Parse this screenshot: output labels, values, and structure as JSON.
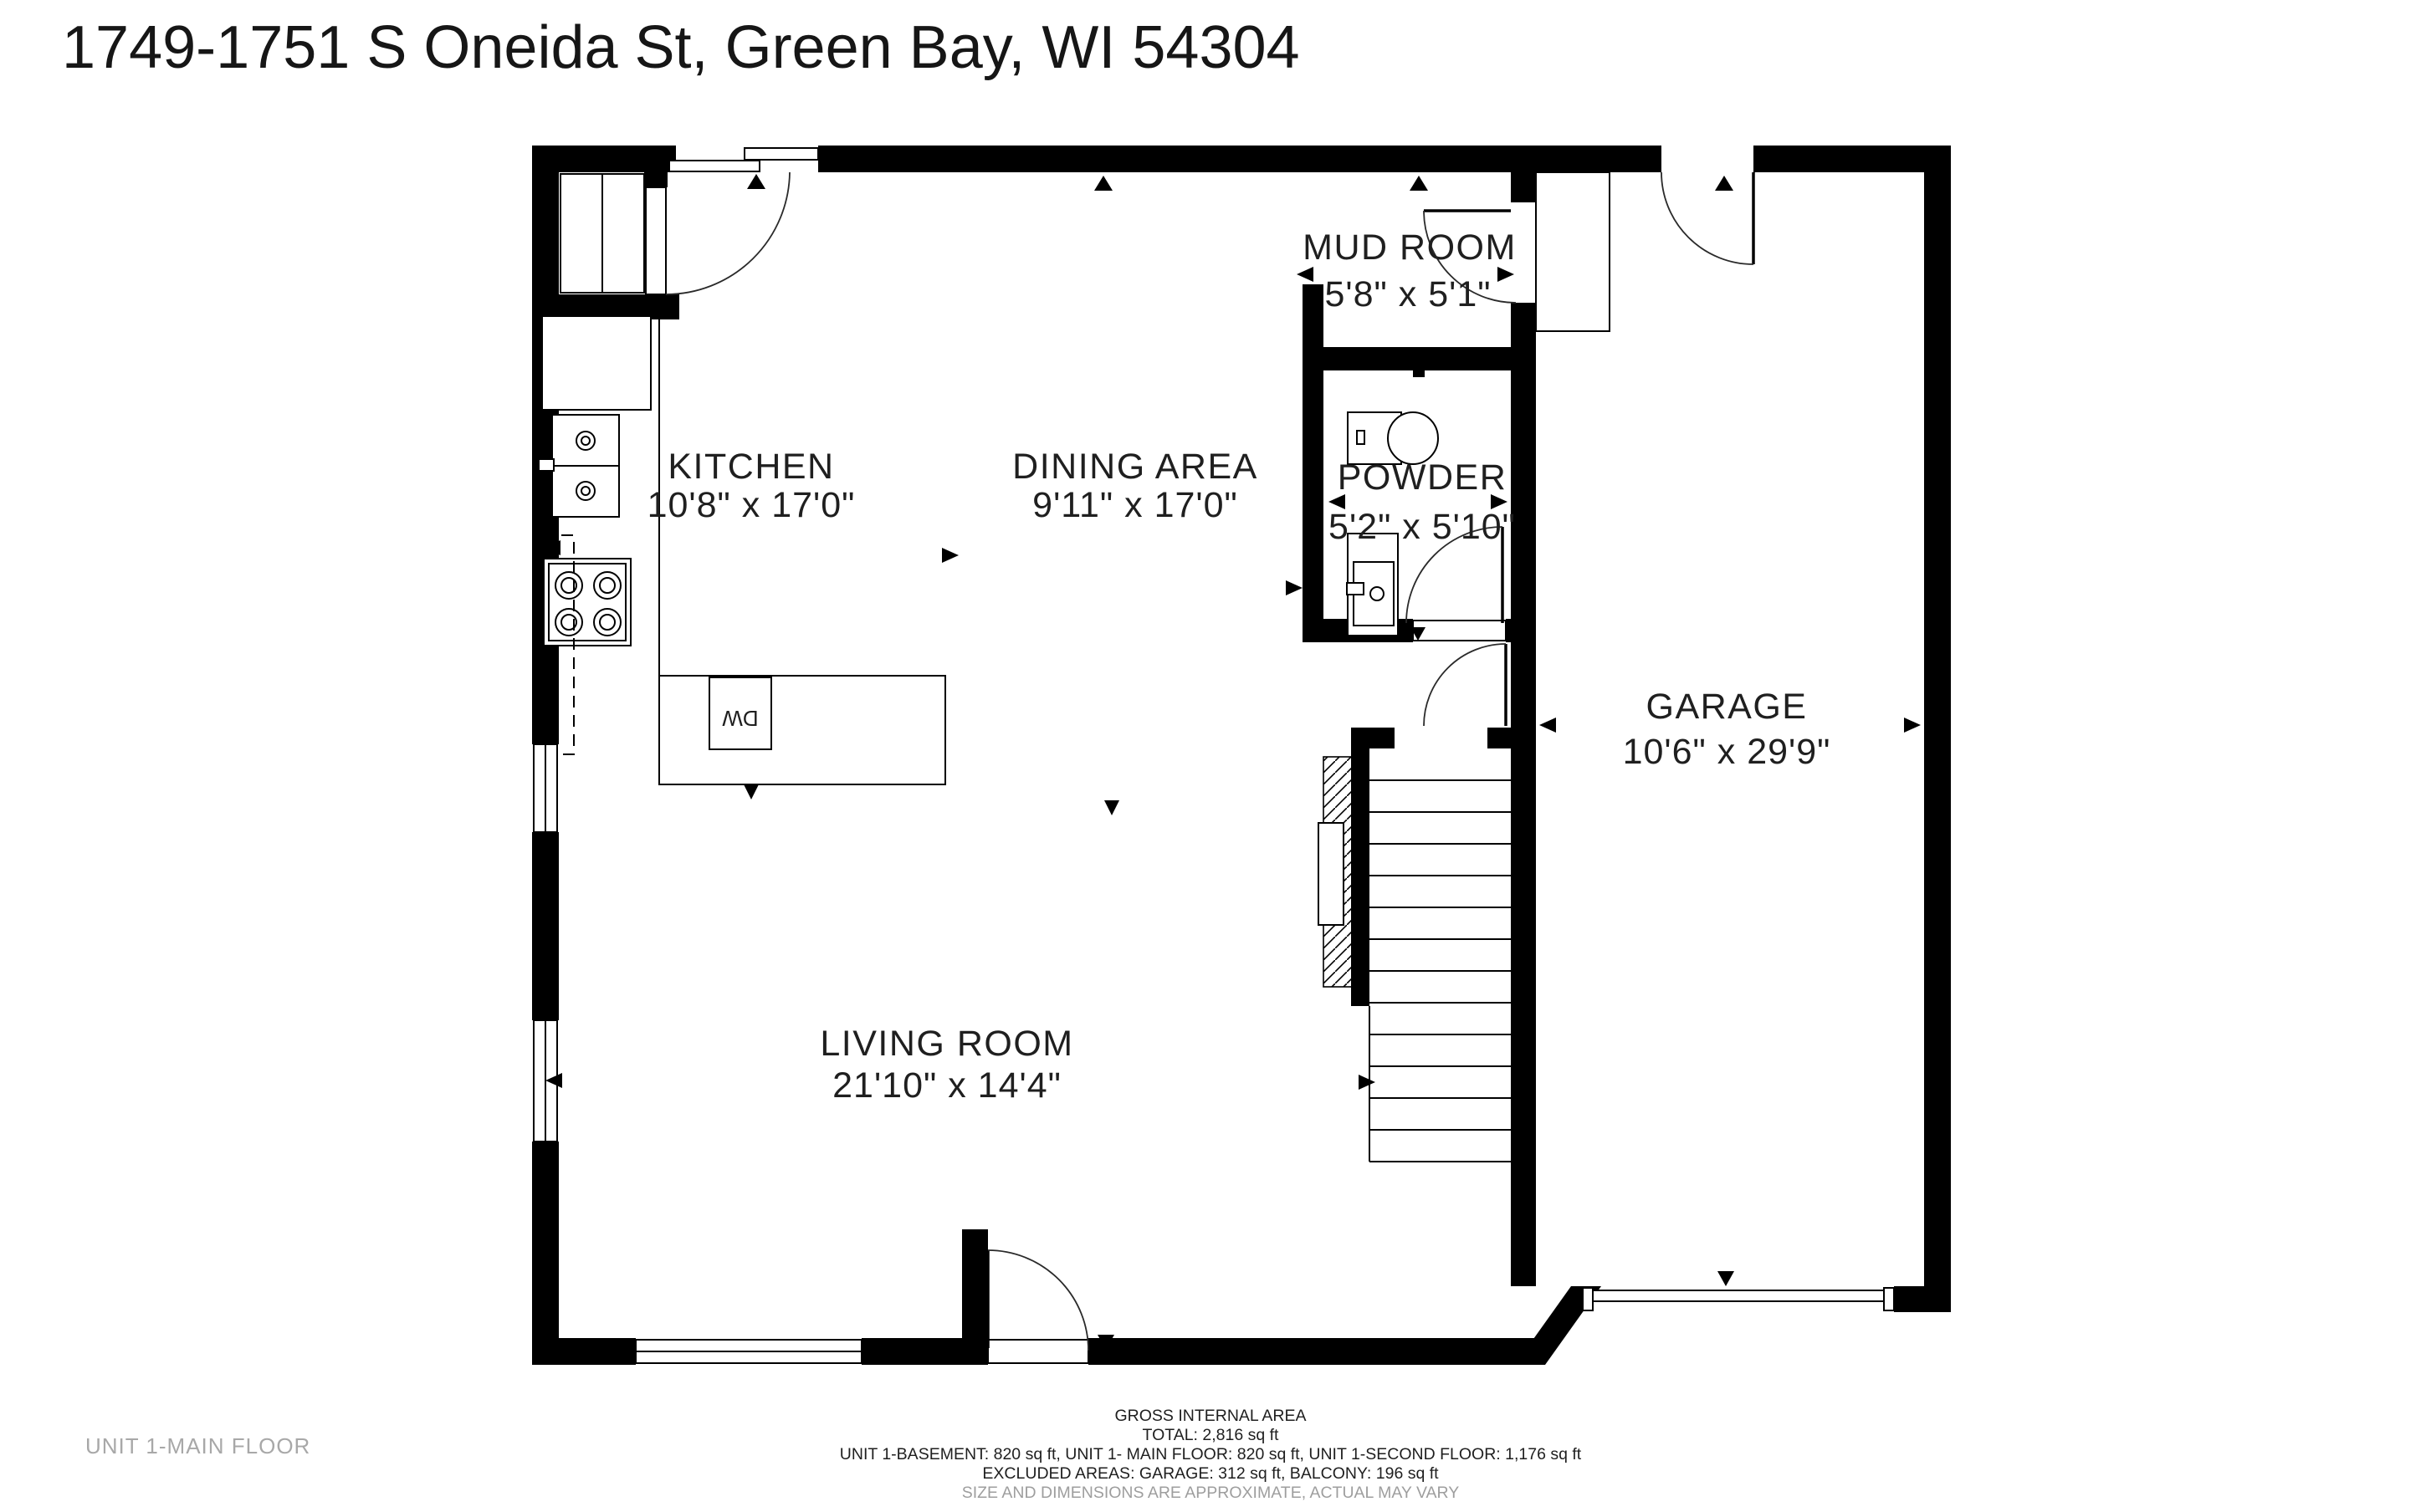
{
  "title": "1749-1751 S Oneida St, Green Bay, WI 54304",
  "floor_label": "UNIT 1-MAIN FLOOR",
  "rooms": [
    {
      "name": "KITCHEN",
      "dims": "10'8\" x 17'0\""
    },
    {
      "name": "DINING AREA",
      "dims": "9'11\" x 17'0\""
    },
    {
      "name": "MUD ROOM",
      "dims": "5'8\" x 5'1\""
    },
    {
      "name": "POWDER",
      "dims": "5'2\" x 5'10\""
    },
    {
      "name": "GARAGE",
      "dims": "10'6\" x 29'9\""
    },
    {
      "name": "LIVING ROOM",
      "dims": "21'10\" x 14'4\""
    }
  ],
  "appliances": {
    "dishwasher_label": "DW"
  },
  "footer": {
    "line1": "GROSS INTERNAL AREA",
    "line2": "TOTAL: 2,816 sq ft",
    "line3": "UNIT 1-BASEMENT: 820 sq ft, UNIT 1- MAIN FLOOR: 820 sq ft, UNIT 1-SECOND FLOOR: 1,176 sq ft",
    "line4": "EXCLUDED AREAS: GARAGE: 312 sq ft, BALCONY: 196 sq ft",
    "line5": "SIZE AND DIMENSIONS ARE APPROXIMATE, ACTUAL MAY VARY"
  },
  "colors": {
    "wall": "#000000",
    "text": "#1f1f1f",
    "muted_text": "#a8a8a8",
    "footer_muted": "#9e9e9e",
    "background": "#ffffff"
  }
}
